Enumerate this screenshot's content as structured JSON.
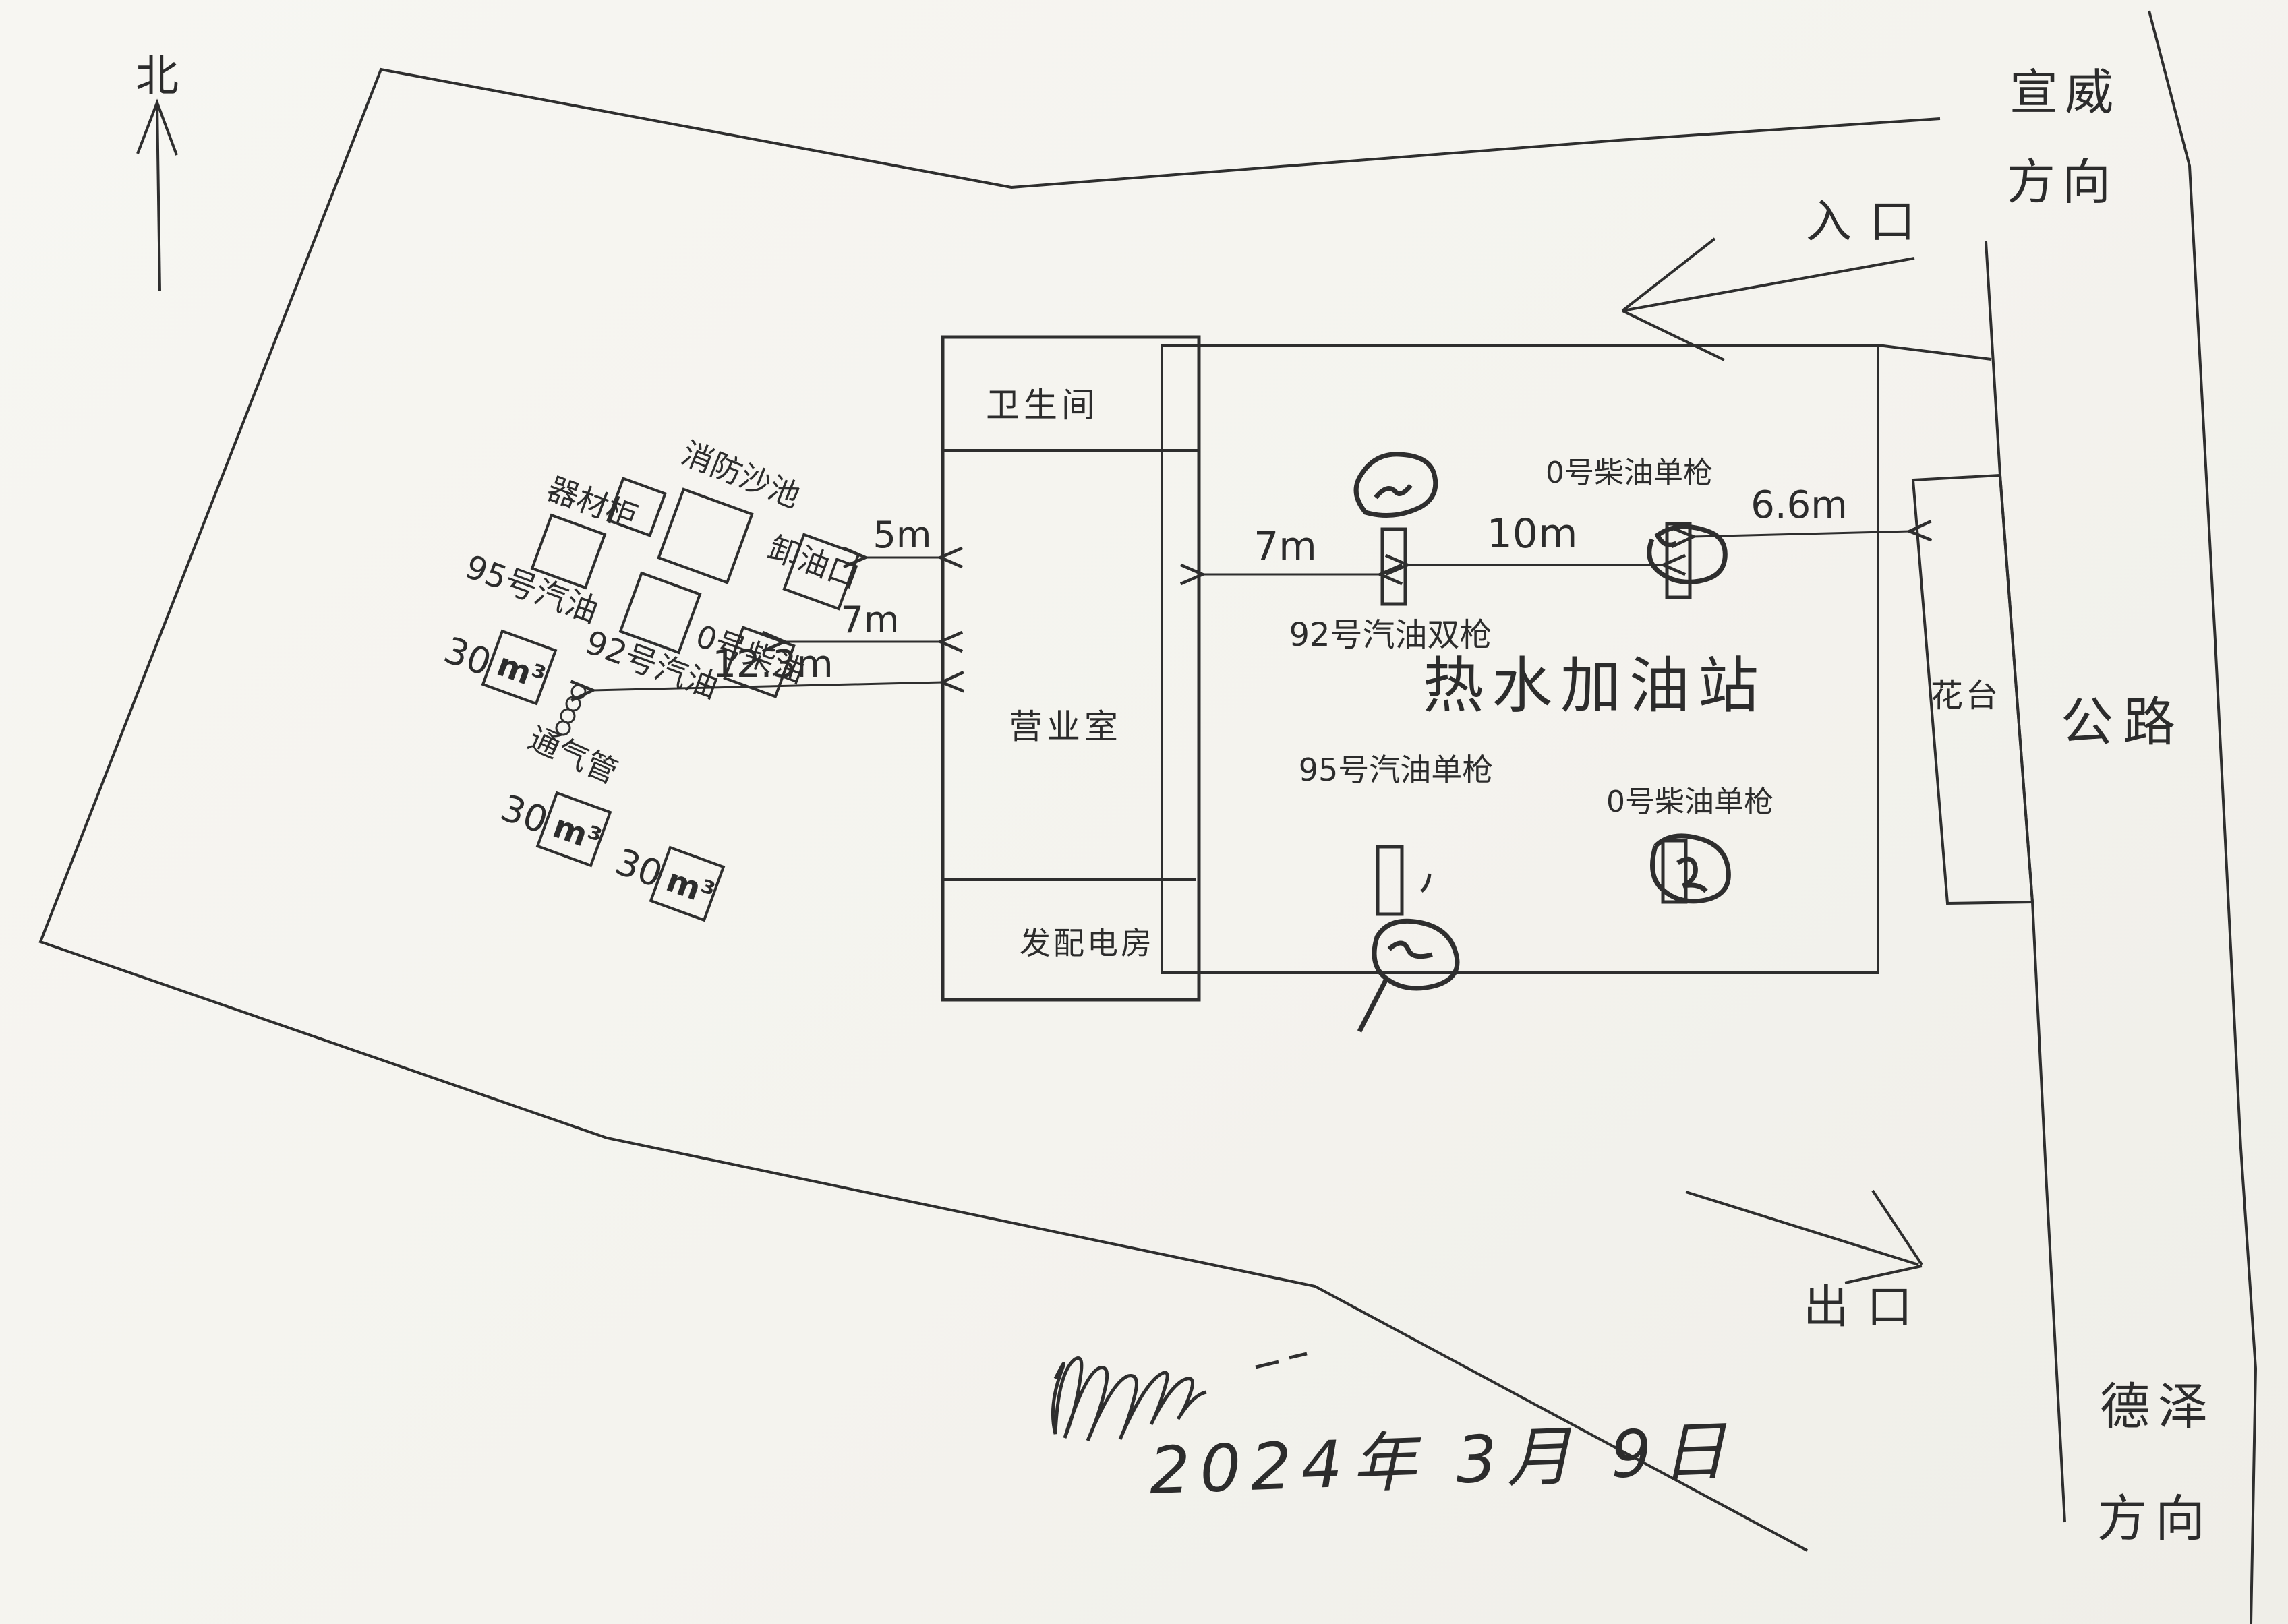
{
  "diagram": {
    "title": "热水加油站",
    "compass": {
      "north": "北"
    },
    "directions": {
      "top_right_line1": "宣威",
      "top_right_line2": "方向",
      "entrance": "入口",
      "exit": "出口",
      "bottom_right_line1": "德泽",
      "bottom_right_line2": "方向"
    },
    "road": {
      "highway": "公路",
      "flower_bed": "花台"
    },
    "buildings": {
      "toilet": "卫生间",
      "office": "营业室",
      "power_room": "发配电房"
    },
    "tank_area": {
      "equipment_cabinet": "器材柜",
      "fire_sand_pool": "消防沙池",
      "unloading_port": "卸油口",
      "gasoline_95": "95号汽油",
      "gasoline_92": "92号汽油",
      "diesel_0": "0号柴油",
      "vent_pipe": "通气管",
      "tanks": [
        {
          "num": "30",
          "unit": "m³"
        },
        {
          "num": "30",
          "unit": "m³"
        },
        {
          "num": "30",
          "unit": "m³"
        }
      ]
    },
    "dispensers": {
      "d92_double": "92号汽油双枪",
      "d0_single_top": "0号柴油单枪",
      "d95_single": "95号汽油单枪",
      "d0_single_bottom": "0号柴油单枪"
    },
    "dimensions": {
      "dim_5m": "5m",
      "dim_7m_left": "7m",
      "dim_12_3m": "12.3m",
      "dim_7m_right": "7m",
      "dim_10m": "10m",
      "dim_6_6m": "6.6m"
    },
    "footer": {
      "date": "2024年 3月 9日"
    }
  }
}
